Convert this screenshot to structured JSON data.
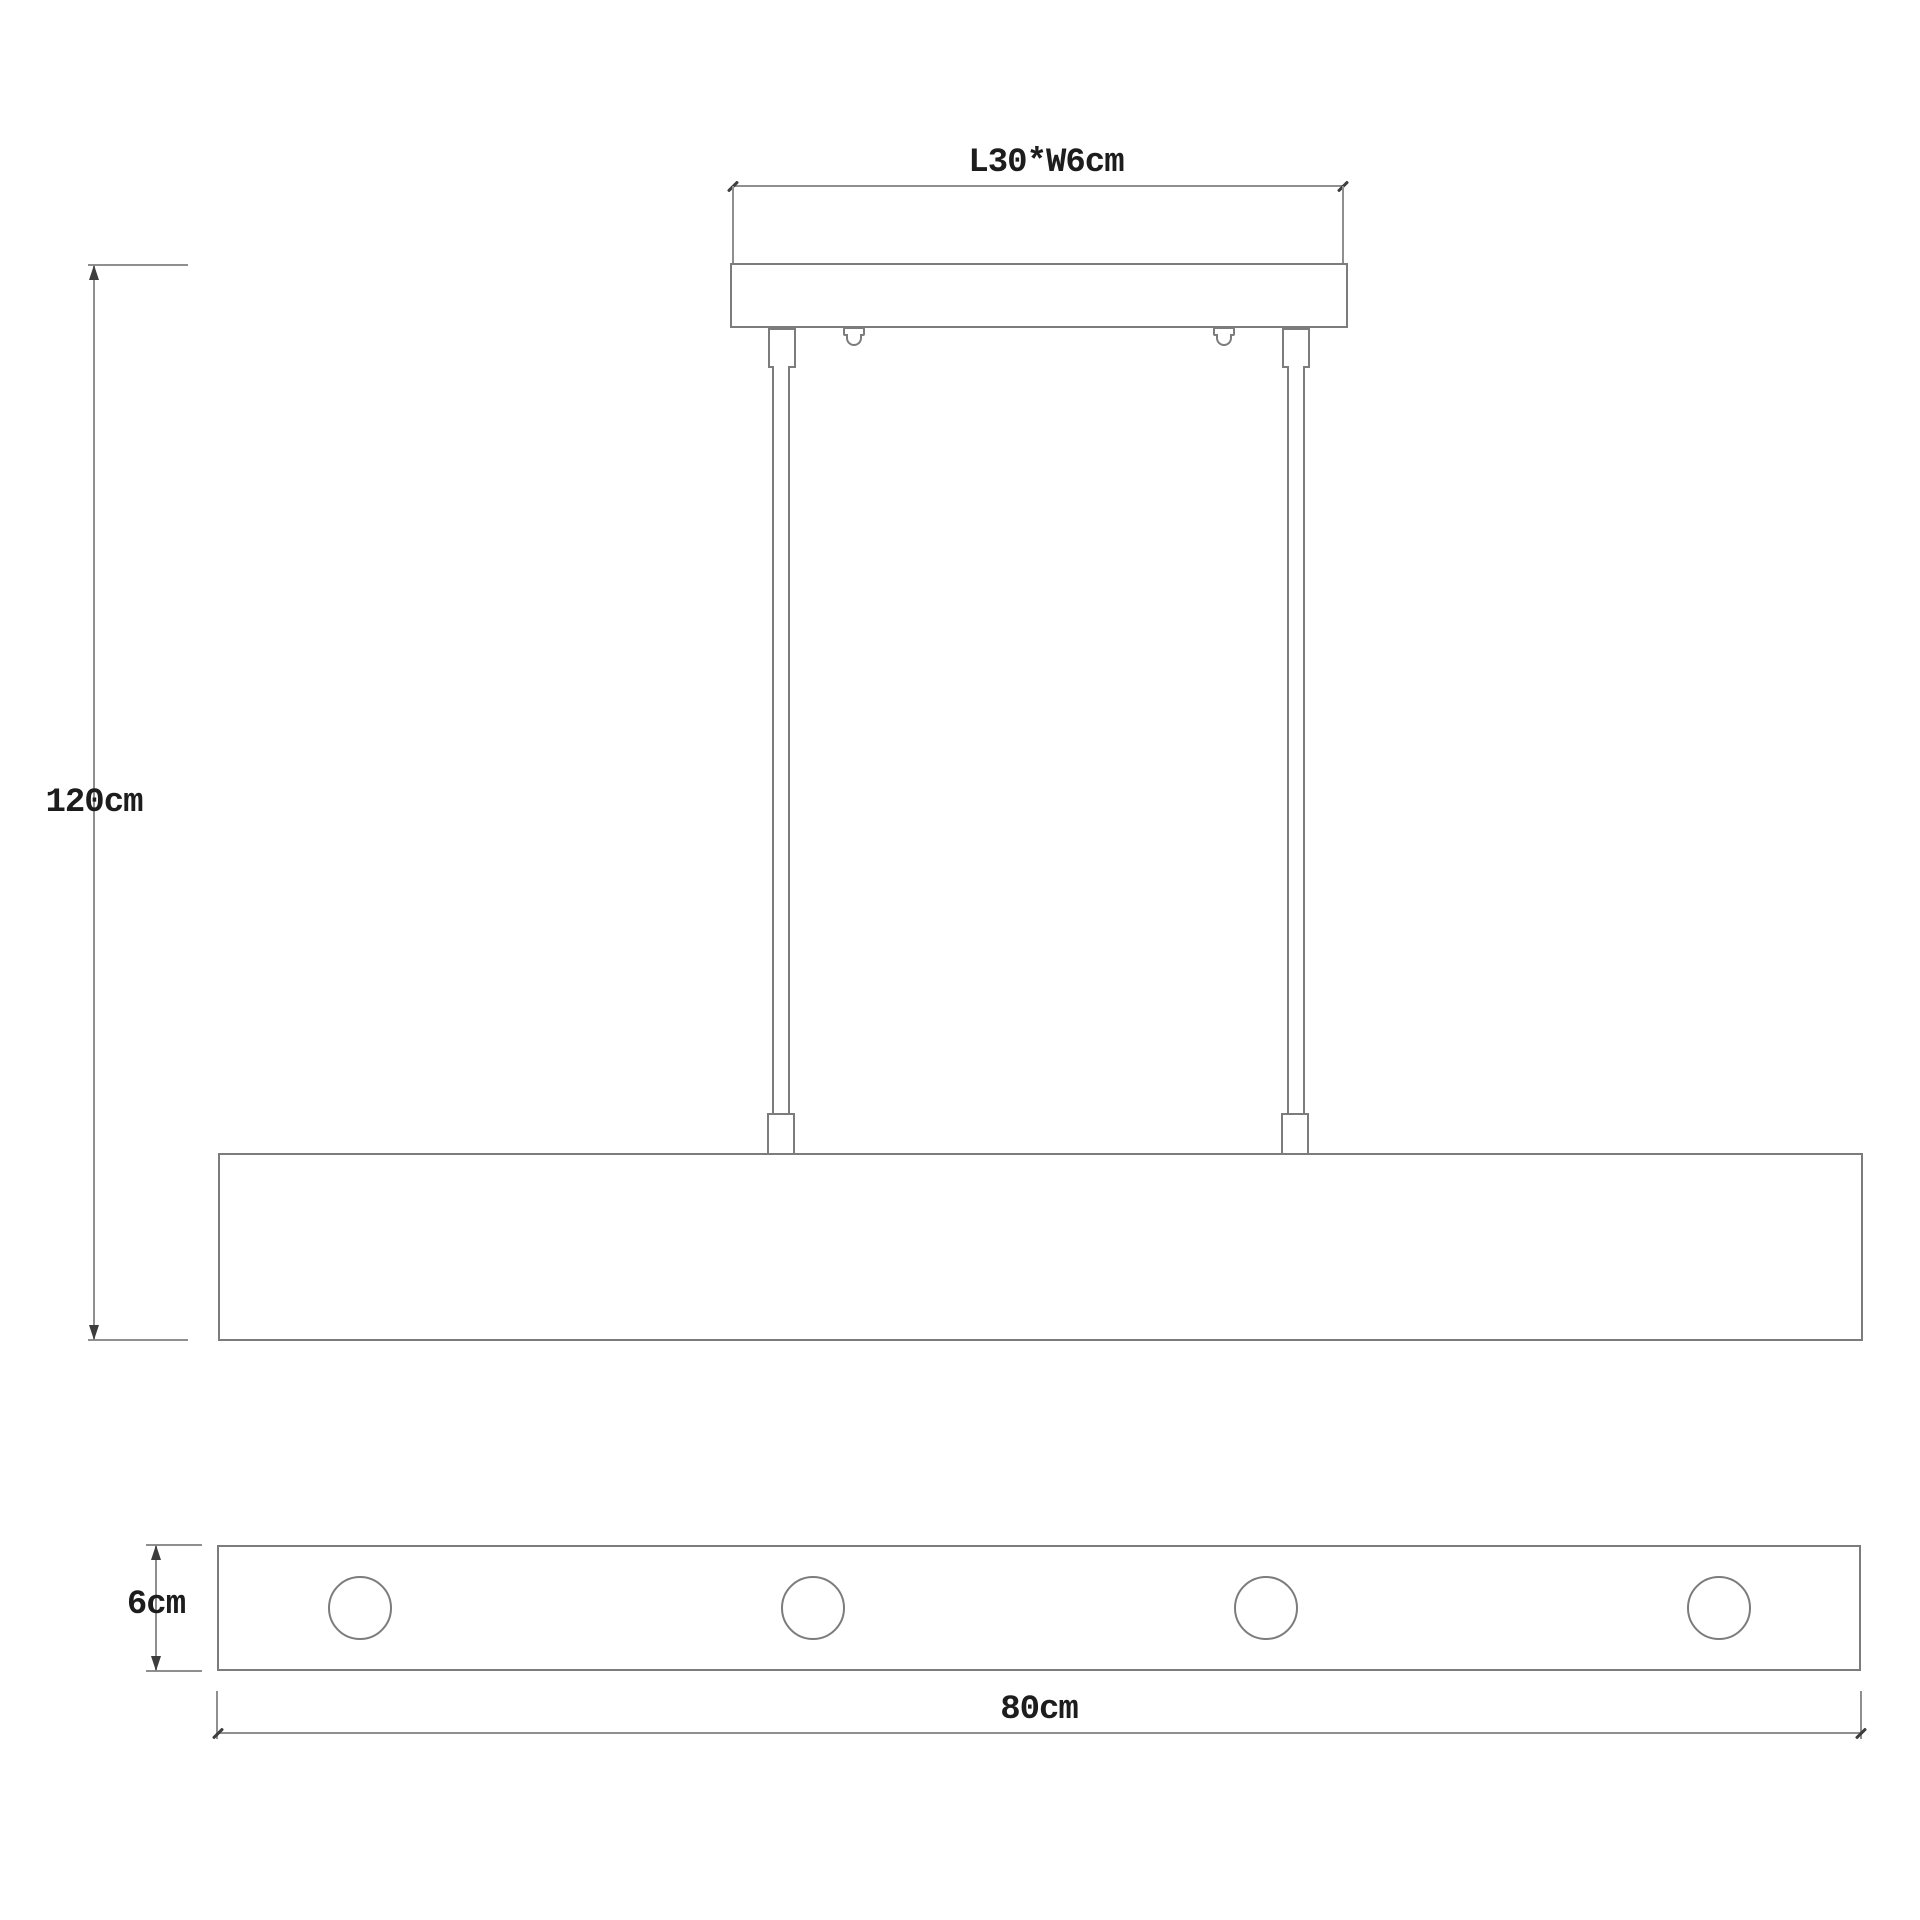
{
  "colors": {
    "background": "#ffffff",
    "line": "#7c7c7c",
    "dimension_line": "#8f8f8f",
    "marks": "#3d3d3d",
    "text": "#1d1d1d"
  },
  "labels": {
    "canopy_size": "L30*W6cm",
    "suspension_height": "120cm",
    "fixture_depth": "6cm",
    "fixture_length": "80cm"
  },
  "front_view": {
    "rod_count": 2,
    "screw_count": 2
  },
  "bottom_view": {
    "light_count": 4
  }
}
